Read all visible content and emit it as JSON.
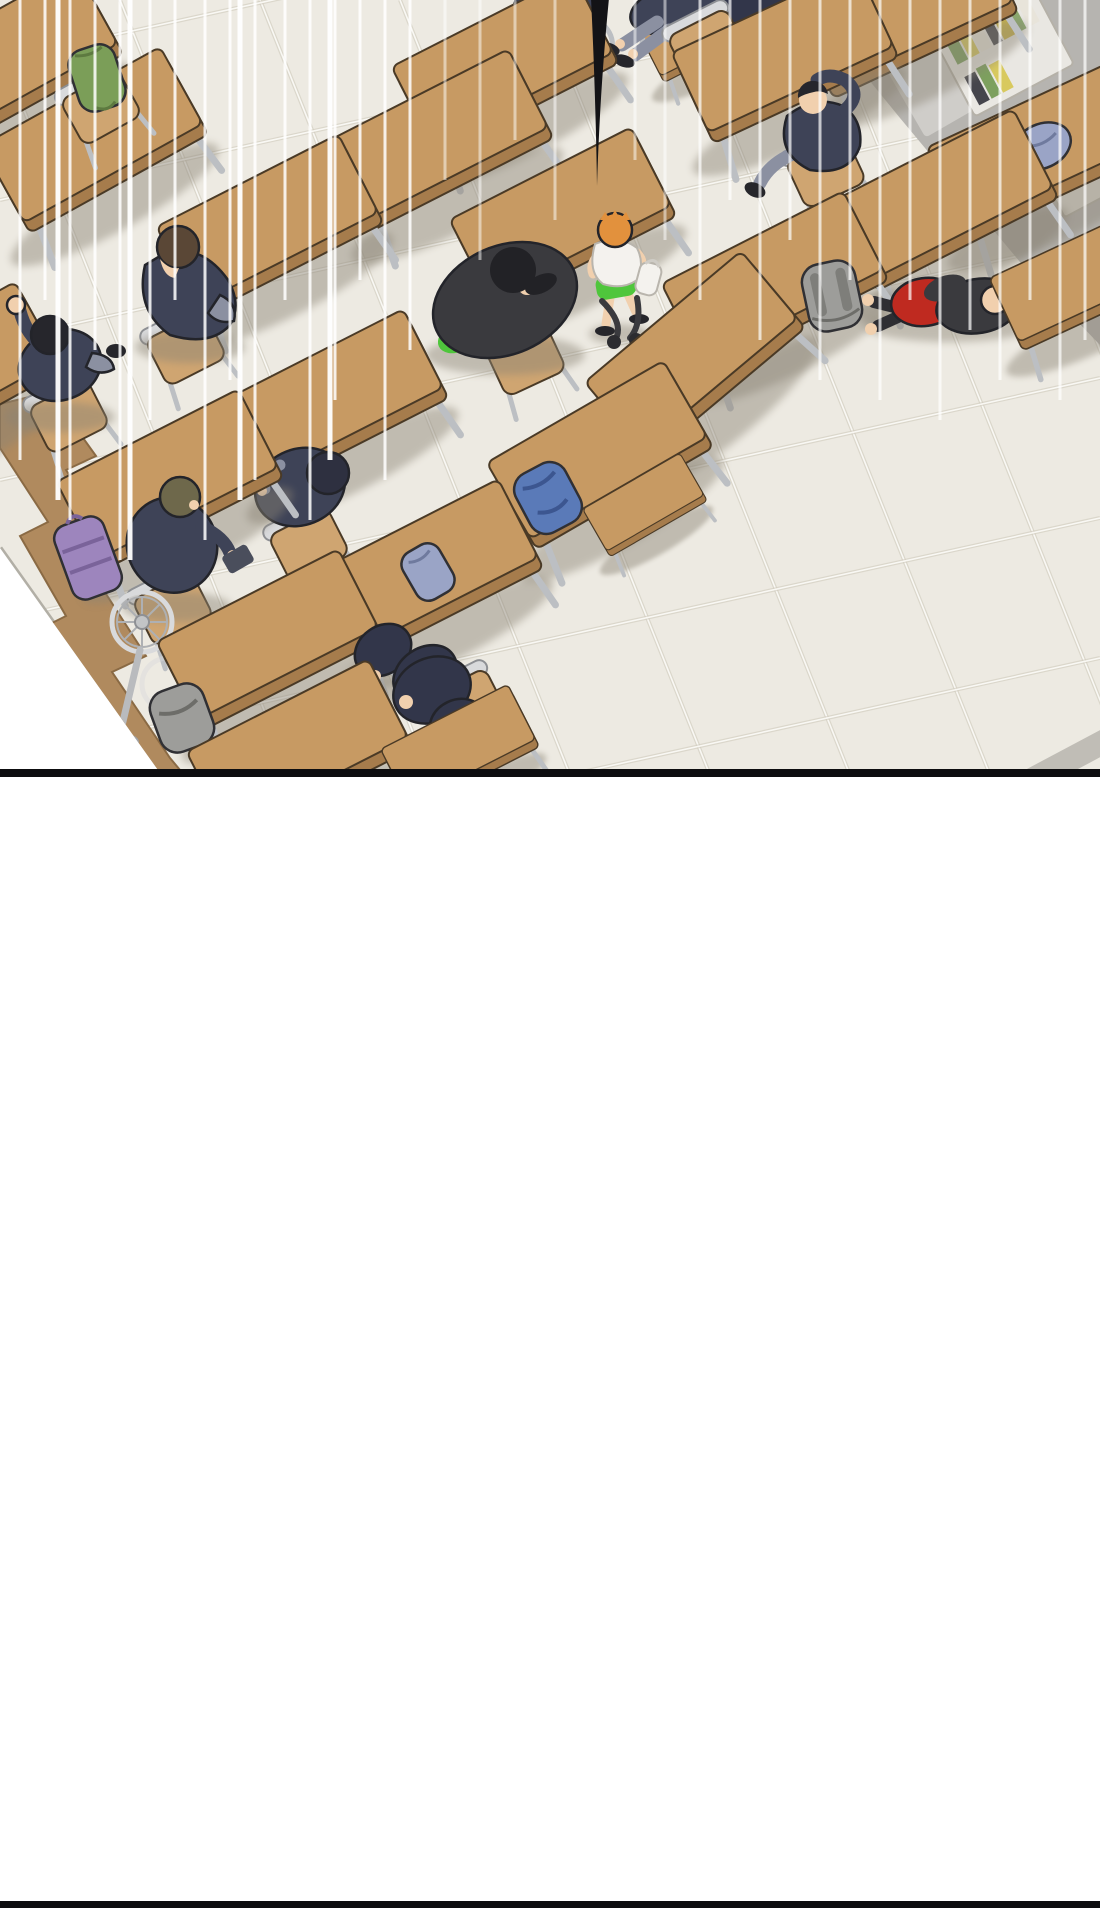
{
  "page": {
    "kind": "webtoon-comic-panel",
    "background": "#ffffff",
    "width": 1100,
    "height": 1908
  },
  "panel": {
    "scene": "isometric-classroom-from-above",
    "scene_bottom_y": 770,
    "page_bottom_border_y": 1901
  },
  "colors": {
    "page_bg": "#ffffff",
    "floor": "#edeae2",
    "floor_grout_dark": "#cfcabc",
    "floor_grout_light": "#fbfaf6",
    "floor_edge": "#b2afa6",
    "desk_top": "#c79a63",
    "desk_edge": "#a67c4c",
    "wood_outline": "#4a3a26",
    "chair_wood": "#cfa571",
    "wood_platform": "#b08a5e",
    "metal": "#bcbfc3",
    "metal_light": "#d9dadc",
    "uniform_navy": "#3e4357",
    "uniform_dark": "#32364a",
    "charcoal": "#3a3a3e",
    "pants_gray": "#8b90a1",
    "skin": "#f1d0ae",
    "hair_black": "#26262c",
    "hair_brown": "#5a4736",
    "hair_olive": "#6e684b",
    "hair_orange": "#e2913d",
    "shirt_white": "#f4f2ee",
    "shorts_green": "#4fc63c",
    "shirt_red": "#bf2a20",
    "bag_green": "#7b9e58",
    "bag_purple": "#9d85bd",
    "bag_blue": "#5a7ab8",
    "bag_periwinkle": "#9aa4c6",
    "bag_gray": "#9d9d9a",
    "wall_gray": "#b6b4b0",
    "wall_gray_light": "#cfcdc9",
    "shelf_white": "#e9e7e2",
    "cabinet_brown": "#8d7352",
    "books": [
      "#7da05e",
      "#d8c95e",
      "#e8e4da",
      "#45454c",
      "#c9b44a",
      "#8aa86e"
    ],
    "speed_line": "#ffffff",
    "shadow_c": "#8a8375",
    "tail": "#131316",
    "panel_border": "#0d0d0f"
  },
  "objects": {
    "effects": [
      "vertical-speed-lines",
      "speech-bubble-tail"
    ],
    "furniture": [
      "school-desks",
      "school-chairs",
      "small-stool-desk",
      "wooden-platform-zigzag",
      "electric-fan",
      "bookshelf-with-books",
      "brown-cabinet",
      "storage-boxes"
    ],
    "students": [
      "students-cut-at-top-edge",
      "student-slippers-legs-crossed",
      "student-blazer-arm-behind-head",
      "student-head-down-at-desk",
      "student-stretching-fist-up",
      "student-heavy-black-cap",
      "kid-walking-white-shirt-green-shorts",
      "student-lying-red-shirt",
      "student-olive-hair-at-desk",
      "student-slumped-sleeping",
      "student-lying-face-down",
      "student-slumped-on-floor"
    ],
    "props": [
      "green-backpack-on-chair",
      "purple-backpack-on-floor",
      "blue-backpack-on-floor",
      "periwinkle-bag-on-desk",
      "periwinkle-bag-right-desk",
      "gray-backpack-on-floor",
      "gray-schoolbag-bottom"
    ]
  }
}
